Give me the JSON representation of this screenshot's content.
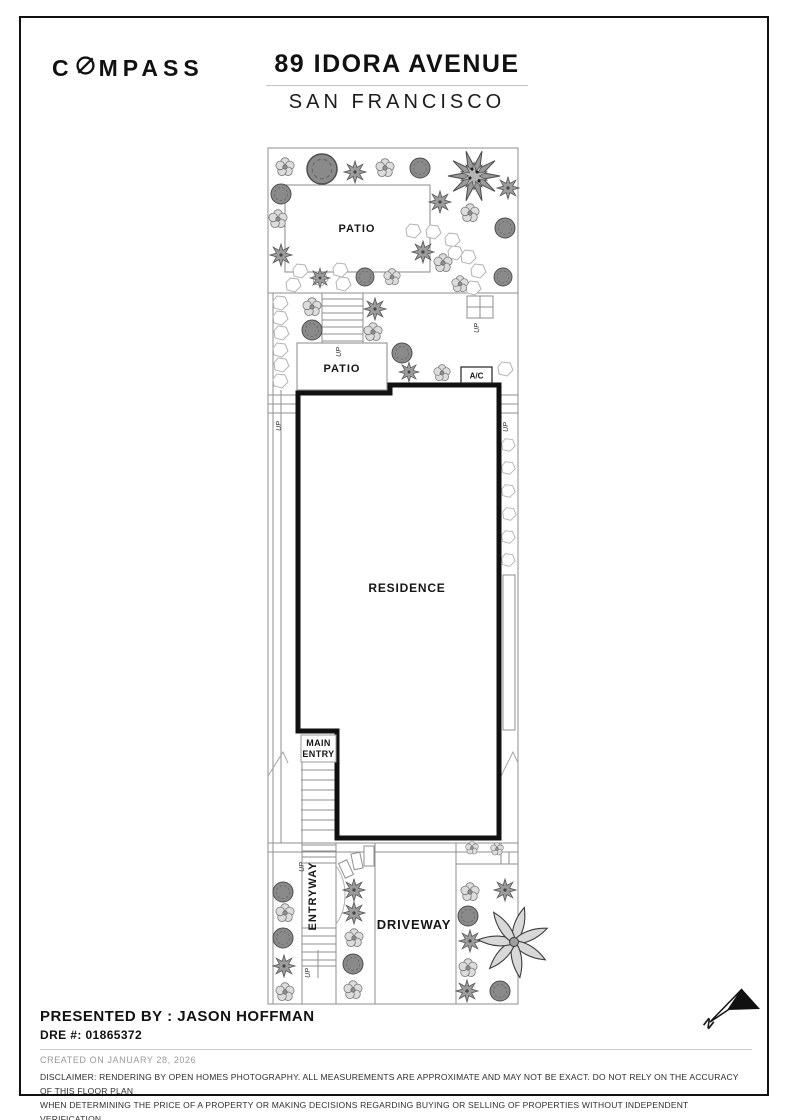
{
  "header": {
    "brand_prefix": "C",
    "brand_suffix": "MPASS",
    "title": "89 IDORA AVENUE",
    "subtitle": "SAN FRANCISCO"
  },
  "plan": {
    "labels": {
      "patio_top": "PATIO",
      "patio_mid": "PATIO",
      "ac": "A/C",
      "residence": "RESIDENCE",
      "main_entry_line1": "MAIN",
      "main_entry_line2": "ENTRY",
      "entryway": "ENTRYWAY",
      "driveway": "DRIVEWAY",
      "up": "UP",
      "north": "N"
    }
  },
  "footer": {
    "presented_by": "PRESENTED BY : JASON HOFFMAN",
    "dre": "DRE #: 01865372",
    "created": "CREATED ON JANUARY 28, 2026",
    "disclaimer_line1": "DISCLAIMER: RENDERING BY OPEN HOMES PHOTOGRAPHY. ALL MEASUREMENTS ARE APPROXIMATE AND MAY NOT BE EXACT. DO NOT RELY ON THE ACCURACY OF THIS FLOOR PLAN",
    "disclaimer_line2": "WHEN DETERMINING THE PRICE OF A PROPERTY OR MAKING DECISIONS REGARDING BUYING OR SELLING OF PROPERTIES WITHOUT INDEPENDENT VERIFICATION."
  },
  "colors": {
    "wall": "#111111",
    "site_line": "#8f8f8f",
    "text": "#161616"
  }
}
